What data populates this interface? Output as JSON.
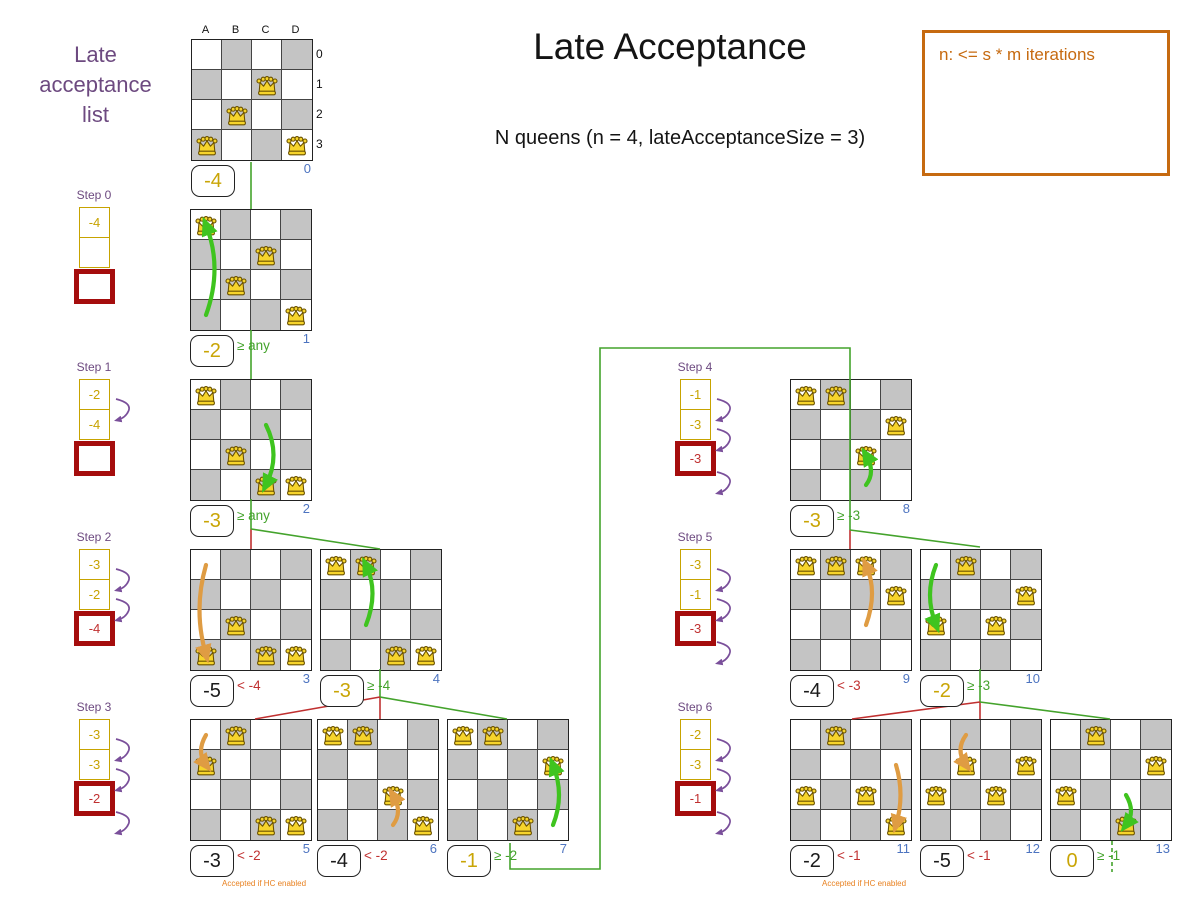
{
  "title": "Late Acceptance",
  "subtitle": "N queens (n = 4, lateAcceptanceSize = 3)",
  "note_box": {
    "text": "n: <= s * m iterations"
  },
  "sidebar": {
    "lines": [
      "Late",
      "acceptance",
      "list"
    ]
  },
  "axes": {
    "columns": [
      "A",
      "B",
      "C",
      "D"
    ],
    "rows": [
      "0",
      "1",
      "2",
      "3"
    ]
  },
  "colors": {
    "gold": "#c7a300",
    "purple": "#6d4a80",
    "arrow_purple": "#7a4f9a",
    "green": "#44a32c",
    "arrow_green": "#3fc41f",
    "red": "#c03030",
    "dark_red": "#a50d0d",
    "orange": "#c66a10",
    "note_orange": "#e8801f",
    "arrow_orange": "#df9c43",
    "blue": "#4d74c0",
    "gray_cell": "#c4c4c4"
  },
  "steps": [
    {
      "label": "Step 0",
      "x": 79,
      "y": 207,
      "cells": [
        {
          "value": "-4",
          "type": "gold"
        },
        {
          "value": "",
          "type": "gold"
        },
        {
          "value": "",
          "type": "red"
        }
      ],
      "arrows": []
    },
    {
      "label": "Step 1",
      "x": 79,
      "y": 379,
      "cells": [
        {
          "value": "-2",
          "type": "gold"
        },
        {
          "value": "-4",
          "type": "gold"
        },
        {
          "value": "",
          "type": "red"
        }
      ],
      "arrows": [
        0
      ]
    },
    {
      "label": "Step 2",
      "x": 79,
      "y": 549,
      "cells": [
        {
          "value": "-3",
          "type": "gold"
        },
        {
          "value": "-2",
          "type": "gold"
        },
        {
          "value": "-4",
          "type": "red"
        }
      ],
      "arrows": [
        0,
        1
      ]
    },
    {
      "label": "Step 3",
      "x": 79,
      "y": 719,
      "cells": [
        {
          "value": "-3",
          "type": "gold"
        },
        {
          "value": "-3",
          "type": "gold"
        },
        {
          "value": "-2",
          "type": "red"
        }
      ],
      "arrows": [
        0,
        1,
        2
      ]
    },
    {
      "label": "Step 4",
      "x": 680,
      "y": 379,
      "cells": [
        {
          "value": "-1",
          "type": "gold"
        },
        {
          "value": "-3",
          "type": "gold"
        },
        {
          "value": "-3",
          "type": "red"
        }
      ],
      "arrows": [
        0,
        1,
        2
      ]
    },
    {
      "label": "Step 5",
      "x": 680,
      "y": 549,
      "cells": [
        {
          "value": "-3",
          "type": "gold"
        },
        {
          "value": "-1",
          "type": "gold"
        },
        {
          "value": "-3",
          "type": "red"
        }
      ],
      "arrows": [
        0,
        1,
        2
      ]
    },
    {
      "label": "Step 6",
      "x": 680,
      "y": 719,
      "cells": [
        {
          "value": "-2",
          "type": "gold"
        },
        {
          "value": "-3",
          "type": "gold"
        },
        {
          "value": "-1",
          "type": "red"
        }
      ],
      "arrows": [
        0,
        1,
        2
      ]
    }
  ],
  "boards": [
    {
      "index": "0",
      "x": 191,
      "y": 39,
      "axes": true,
      "queens": [
        [
          2,
          1
        ],
        [
          1,
          2
        ],
        [
          0,
          3
        ],
        [
          3,
          3
        ]
      ],
      "move": null,
      "score": "-4",
      "score_style": "gold",
      "gate": "",
      "gate_style": "",
      "note": ""
    },
    {
      "index": "1",
      "x": 190,
      "y": 209,
      "queens": [
        [
          0,
          0
        ],
        [
          2,
          1
        ],
        [
          1,
          2
        ],
        [
          3,
          3
        ]
      ],
      "move": {
        "from": [
          0,
          3
        ],
        "to": [
          0,
          0
        ],
        "ctrl": [
          32,
          58
        ],
        "color": "green"
      },
      "score": "-2",
      "score_style": "gold",
      "gate": "≥ any",
      "gate_style": "green",
      "note": ""
    },
    {
      "index": "2",
      "x": 190,
      "y": 379,
      "queens": [
        [
          0,
          0
        ],
        [
          1,
          2
        ],
        [
          2,
          3
        ],
        [
          3,
          3
        ]
      ],
      "move": {
        "from": [
          2,
          1
        ],
        "to": [
          2,
          3
        ],
        "ctrl": [
          90,
          75
        ],
        "color": "green"
      },
      "score": "-3",
      "score_style": "gold",
      "gate": "≥ any",
      "gate_style": "green",
      "note": ""
    },
    {
      "index": "3",
      "x": 190,
      "y": 549,
      "queens": [
        [
          1,
          2
        ],
        [
          0,
          3
        ],
        [
          2,
          3
        ],
        [
          3,
          3
        ]
      ],
      "move": {
        "from": [
          0,
          0
        ],
        "to": [
          0,
          3
        ],
        "ctrl": [
          2,
          60
        ],
        "color": "orange"
      },
      "score": "-5",
      "score_style": "black",
      "gate": "< -4",
      "gate_style": "red",
      "note": ""
    },
    {
      "index": "4",
      "x": 320,
      "y": 549,
      "queens": [
        [
          0,
          0
        ],
        [
          1,
          0
        ],
        [
          2,
          3
        ],
        [
          3,
          3
        ]
      ],
      "move": {
        "from": [
          1,
          2
        ],
        "to": [
          1,
          0
        ],
        "ctrl": [
          58,
          42
        ],
        "color": "green"
      },
      "score": "-3",
      "score_style": "gold",
      "gate": "≥ -4",
      "gate_style": "green",
      "note": ""
    },
    {
      "index": "5",
      "x": 190,
      "y": 719,
      "queens": [
        [
          1,
          0
        ],
        [
          0,
          1
        ],
        [
          2,
          3
        ],
        [
          3,
          3
        ]
      ],
      "move": {
        "from": [
          0,
          0
        ],
        "to": [
          0,
          1
        ],
        "ctrl": [
          5,
          32
        ],
        "color": "orange"
      },
      "score": "-3",
      "score_style": "black",
      "gate": "< -2",
      "gate_style": "red",
      "note": "Accepted if HC enabled"
    },
    {
      "index": "6",
      "x": 317,
      "y": 719,
      "queens": [
        [
          0,
          0
        ],
        [
          1,
          0
        ],
        [
          2,
          2
        ],
        [
          3,
          3
        ]
      ],
      "move": {
        "from": [
          2,
          3
        ],
        "to": [
          2,
          2
        ],
        "ctrl": [
          85,
          92
        ],
        "color": "orange"
      },
      "score": "-4",
      "score_style": "black",
      "gate": "< -2",
      "gate_style": "red",
      "note": ""
    },
    {
      "index": "7",
      "x": 447,
      "y": 719,
      "queens": [
        [
          0,
          0
        ],
        [
          1,
          0
        ],
        [
          3,
          1
        ],
        [
          2,
          3
        ]
      ],
      "move": {
        "from": [
          3,
          3
        ],
        "to": [
          3,
          1
        ],
        "ctrl": [
          117,
          75
        ],
        "color": "green"
      },
      "score": "-1",
      "score_style": "gold",
      "gate": "≥ -2",
      "gate_style": "green",
      "note": ""
    },
    {
      "index": "8",
      "x": 790,
      "y": 379,
      "queens": [
        [
          0,
          0
        ],
        [
          1,
          0
        ],
        [
          3,
          1
        ],
        [
          2,
          2
        ]
      ],
      "move": {
        "from": [
          2,
          3
        ],
        "to": [
          2,
          2
        ],
        "ctrl": [
          85,
          92
        ],
        "color": "green"
      },
      "score": "-3",
      "score_style": "gold",
      "gate": "≥ -3",
      "gate_style": "green",
      "note": ""
    },
    {
      "index": "9",
      "x": 790,
      "y": 549,
      "queens": [
        [
          0,
          0
        ],
        [
          1,
          0
        ],
        [
          2,
          0
        ],
        [
          3,
          1
        ]
      ],
      "move": {
        "from": [
          2,
          2
        ],
        "to": [
          2,
          0
        ],
        "ctrl": [
          87,
          42
        ],
        "color": "orange"
      },
      "score": "-4",
      "score_style": "black",
      "gate": "< -3",
      "gate_style": "red",
      "note": ""
    },
    {
      "index": "10",
      "x": 920,
      "y": 549,
      "queens": [
        [
          1,
          0
        ],
        [
          3,
          1
        ],
        [
          0,
          2
        ],
        [
          2,
          2
        ]
      ],
      "move": {
        "from": [
          0,
          0
        ],
        "to": [
          0,
          2
        ],
        "ctrl": [
          3,
          45
        ],
        "color": "green"
      },
      "score": "-2",
      "score_style": "gold",
      "gate": "≥ -3",
      "gate_style": "green",
      "note": ""
    },
    {
      "index": "11",
      "x": 790,
      "y": 719,
      "queens": [
        [
          1,
          0
        ],
        [
          0,
          2
        ],
        [
          2,
          2
        ],
        [
          3,
          3
        ]
      ],
      "move": {
        "from": [
          3,
          1
        ],
        "to": [
          3,
          3
        ],
        "ctrl": [
          114,
          75
        ],
        "color": "orange"
      },
      "score": "-2",
      "score_style": "black",
      "gate": "< -1",
      "gate_style": "red",
      "note": "Accepted if HC enabled"
    },
    {
      "index": "12",
      "x": 920,
      "y": 719,
      "queens": [
        [
          3,
          1
        ],
        [
          0,
          2
        ],
        [
          2,
          2
        ],
        [
          1,
          1
        ]
      ],
      "move": {
        "from": [
          1,
          0
        ],
        "to": [
          1,
          1
        ],
        "ctrl": [
          34,
          30
        ],
        "color": "orange"
      },
      "score": "-5",
      "score_style": "black",
      "gate": "< -1",
      "gate_style": "red",
      "note": ""
    },
    {
      "index": "13",
      "x": 1050,
      "y": 719,
      "queens": [
        [
          1,
          0
        ],
        [
          3,
          1
        ],
        [
          0,
          2
        ],
        [
          2,
          3
        ]
      ],
      "move": {
        "from": [
          2,
          2
        ],
        "to": [
          2,
          3
        ],
        "ctrl": [
          85,
          92
        ],
        "color": "green"
      },
      "score": "0",
      "score_style": "gold",
      "gate": "≥ -1",
      "gate_style": "green",
      "note": ""
    }
  ],
  "connectors": [
    {
      "color": "green",
      "points": [
        [
          251,
          162
        ],
        [
          251,
          209
        ]
      ]
    },
    {
      "color": "green",
      "points": [
        [
          251,
          330
        ],
        [
          251,
          379
        ]
      ]
    },
    {
      "color": "green",
      "points": [
        [
          251,
          499
        ],
        [
          251,
          529
        ]
      ]
    },
    {
      "color": "red",
      "points": [
        [
          251,
          529
        ],
        [
          251,
          549
        ]
      ]
    },
    {
      "color": "green",
      "points": [
        [
          251,
          529
        ],
        [
          380,
          549
        ]
      ]
    },
    {
      "color": "green",
      "points": [
        [
          380,
          669
        ],
        [
          380,
          697
        ]
      ]
    },
    {
      "color": "red",
      "points": [
        [
          380,
          697
        ],
        [
          380,
          719
        ]
      ]
    },
    {
      "color": "red",
      "points": [
        [
          380,
          697
        ],
        [
          255,
          719
        ]
      ]
    },
    {
      "color": "green",
      "points": [
        [
          380,
          697
        ],
        [
          507,
          719
        ]
      ]
    },
    {
      "color": "green",
      "points": [
        [
          510,
          843
        ],
        [
          510,
          869
        ],
        [
          600,
          869
        ],
        [
          600,
          348
        ],
        [
          850,
          348
        ],
        [
          850,
          530
        ]
      ]
    },
    {
      "color": "red",
      "points": [
        [
          850,
          530
        ],
        [
          850,
          549
        ]
      ]
    },
    {
      "color": "green",
      "points": [
        [
          850,
          530
        ],
        [
          980,
          547
        ]
      ]
    },
    {
      "color": "green",
      "points": [
        [
          980,
          669
        ],
        [
          980,
          702
        ]
      ]
    },
    {
      "color": "red",
      "points": [
        [
          980,
          702
        ],
        [
          980,
          719
        ]
      ]
    },
    {
      "color": "red",
      "points": [
        [
          980,
          702
        ],
        [
          852,
          719
        ]
      ]
    },
    {
      "color": "green",
      "points": [
        [
          980,
          702
        ],
        [
          1110,
          719
        ]
      ]
    },
    {
      "color": "green",
      "dashed": true,
      "points": [
        [
          1112,
          841
        ],
        [
          1112,
          872
        ]
      ]
    }
  ]
}
